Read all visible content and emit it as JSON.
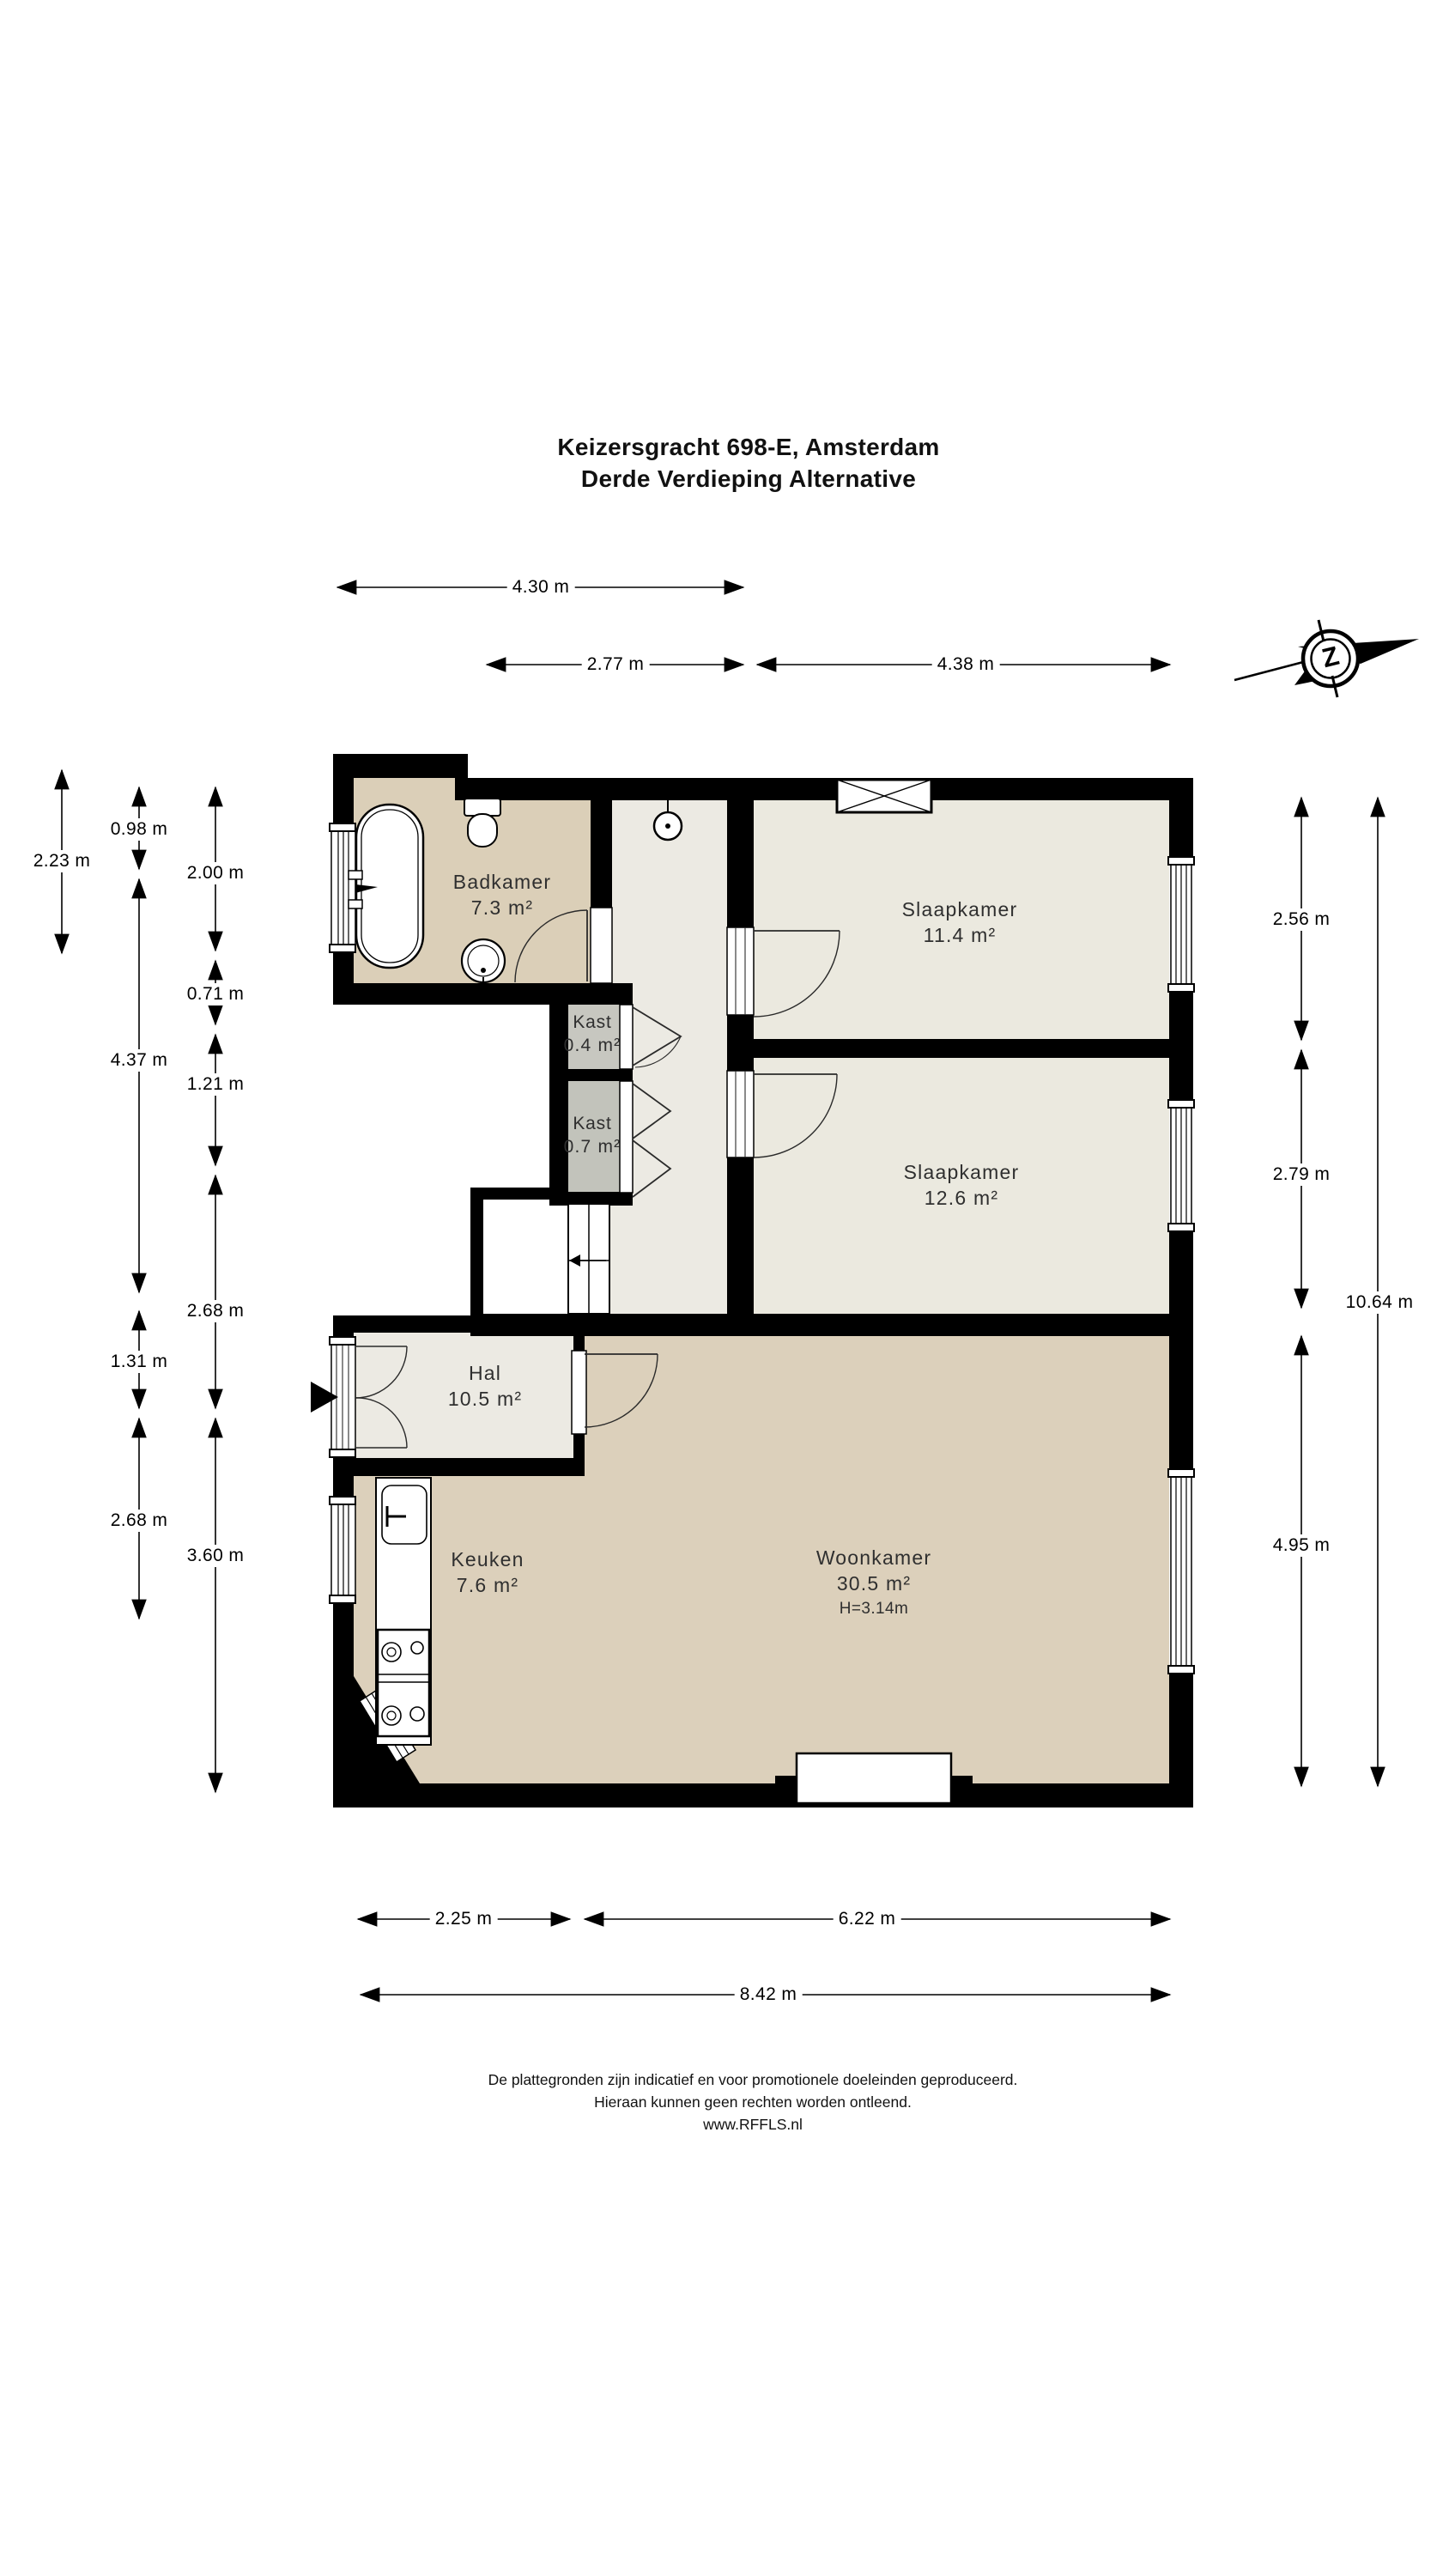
{
  "title": {
    "line1": "Keizersgracht 698-E, Amsterdam",
    "line2": "Derde Verdieping Alternative"
  },
  "compass": {
    "letter": "Z"
  },
  "rooms": {
    "badkamer": {
      "name": "Badkamer",
      "area": "7.3 m²"
    },
    "slaapkamer1": {
      "name": "Slaapkamer",
      "area": "11.4 m²"
    },
    "kast1": {
      "name": "Kast",
      "area": "0.4 m²"
    },
    "kast2": {
      "name": "Kast",
      "area": "0.7 m²"
    },
    "slaapkamer2": {
      "name": "Slaapkamer",
      "area": "12.6 m²"
    },
    "hal": {
      "name": "Hal",
      "area": "10.5 m²"
    },
    "keuken": {
      "name": "Keuken",
      "area": "7.6 m²"
    },
    "woonkamer": {
      "name": "Woonkamer",
      "area": "30.5 m²",
      "ceiling_height": "H=3.14m"
    }
  },
  "dimensions": {
    "top": [
      {
        "label": "4.30 m"
      },
      {
        "label": "2.77 m"
      },
      {
        "label": "4.38 m"
      }
    ],
    "left": [
      {
        "label": "2.23 m"
      },
      {
        "label": "0.98 m"
      },
      {
        "label": "2.00 m"
      },
      {
        "label": "0.71 m"
      },
      {
        "label": "4.37 m"
      },
      {
        "label": "1.21 m"
      },
      {
        "label": "2.68 m"
      },
      {
        "label": "1.31 m"
      },
      {
        "label": "2.68 m"
      },
      {
        "label": "3.60 m"
      }
    ],
    "right": [
      {
        "label": "2.56 m"
      },
      {
        "label": "2.79 m"
      },
      {
        "label": "10.64 m"
      },
      {
        "label": "4.95 m"
      }
    ],
    "bottom": [
      {
        "label": "2.25 m"
      },
      {
        "label": "6.22 m"
      },
      {
        "label": "8.42 m"
      }
    ]
  },
  "footer": {
    "line1": "De plattegronden zijn indicatief en voor promotionele doeleinden geproduceerd.",
    "line2": "Hieraan kunnen geen rechten worden ontleend.",
    "line3": "www.RFFLS.nl"
  },
  "colors": {
    "wall": "#000000",
    "floor_tan": "#dcd0bb",
    "floor_light": "#ebe9df",
    "floor_hal": "#eceae3",
    "floor_kast1": "#c7c7c0",
    "floor_kast2": "#c2c3bb"
  }
}
